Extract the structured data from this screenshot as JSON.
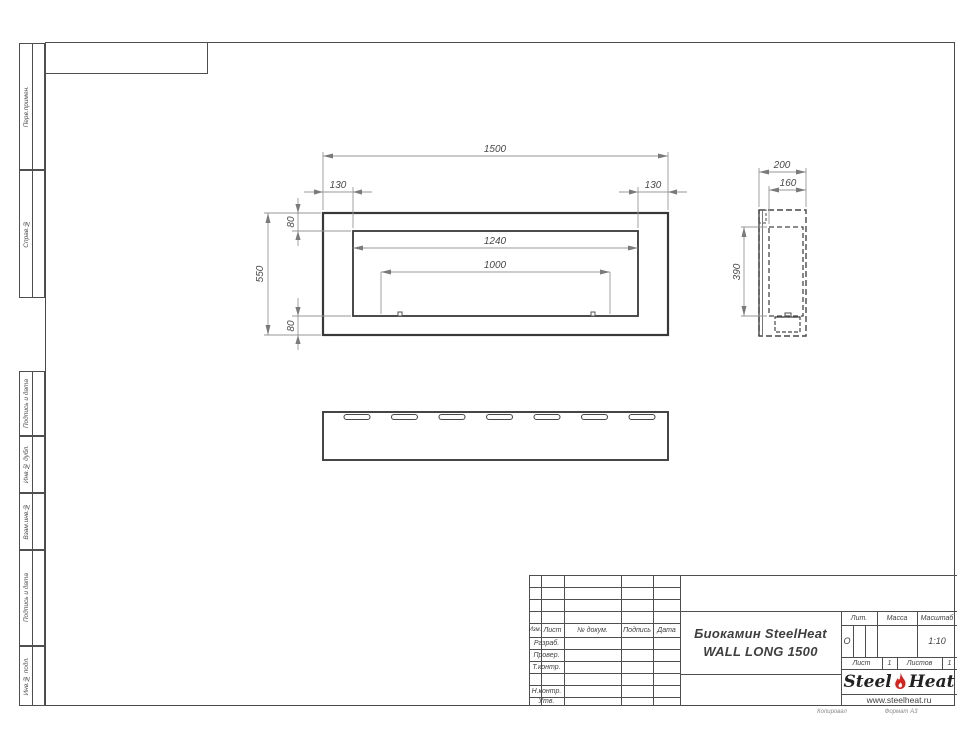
{
  "sidebar": {
    "labels": [
      "Перв.примен.",
      "Справ.№",
      "Подпись и дата",
      "Инв.№ дубл.",
      "Взам.инв.№",
      "Подпись и дата",
      "Инв.№ подл."
    ]
  },
  "drawing": {
    "front": {
      "total_width": "1500",
      "edge_left": "130",
      "edge_right": "130",
      "top_border": "80",
      "height": "550",
      "bottom_border": "80",
      "opening_width": "1240",
      "burner_width": "1000"
    },
    "side": {
      "depth": "200",
      "inner_depth": "160",
      "opening_height": "390"
    }
  },
  "title_block": {
    "cols": {
      "izm": "Изм.",
      "list": "Лист",
      "doc": "№ докум.",
      "sign": "Подпись",
      "date": "Дата"
    },
    "rows": {
      "razrab": "Разраб.",
      "prover": "Провер.",
      "tkontr": "Т.контр.",
      "nkontr": "Н.контр.",
      "utv": "Утв."
    },
    "title1": "Биокамин SteelHeat",
    "title2": "WALL LONG 1500",
    "lit": "Лит.",
    "mass": "Масса",
    "scale": "Масштаб",
    "lit_value": "О",
    "scale_value": "1:10",
    "sheet": "Лист",
    "sheet_value": "1",
    "sheets": "Листов",
    "sheets_value": "1",
    "logo": {
      "steel": "Steel",
      "heat": "Heat",
      "url": "www.steelheat.ru"
    }
  },
  "footer": {
    "copied": "Копировал",
    "format": "Формат А3"
  },
  "colors": {
    "line": "#4a4a4a",
    "flame": "#d8231d"
  }
}
